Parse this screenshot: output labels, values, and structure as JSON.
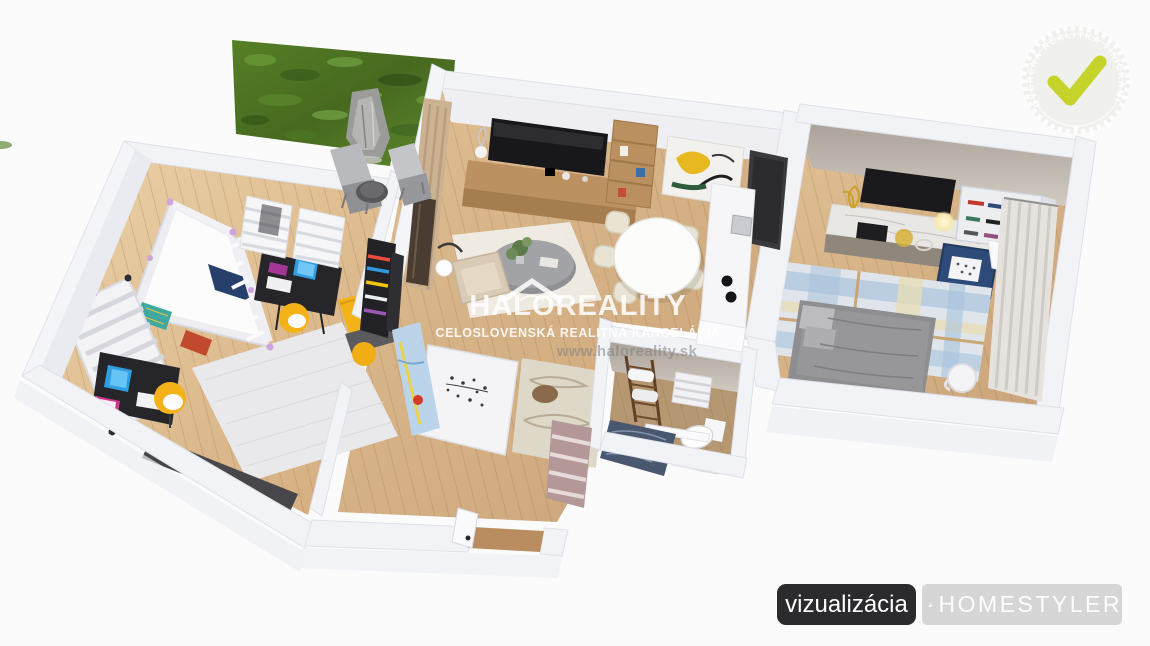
{
  "watermark": {
    "title": "HALOREALITY",
    "subtitle": "CELOSLOVENSKÁ REALITNÁ KANCELÁRIA",
    "website": "www.haloreality.sk",
    "logo": "roof-icon"
  },
  "badge": {
    "circular_text": "OVERENÁ REALITKA TISÍCKAMI KLIENTOV",
    "star": "★",
    "check_icon": "checkmark-icon",
    "check_color": "#c6d32a"
  },
  "footer": {
    "visualization_label": "vizualizácia",
    "brand_name": "HOMESTYLER",
    "brand_icon": "layers-icon"
  },
  "scene": {
    "type": "3d-floorplan-render",
    "rooms": [
      "children-bedroom",
      "living-room-with-kitchen",
      "hallway",
      "bathroom",
      "bedroom"
    ],
    "exterior": [
      "green-wall-panel",
      "lounge-chairs"
    ]
  },
  "colors": {
    "background": "#fbfbfc",
    "wall": "#f2f3f7",
    "floor_wood": "#d9b98c",
    "accent_yellow": "#f3b218",
    "accent_navy": "#2e4a78",
    "check_green": "#c6d32a",
    "button_dark": "#2b2b2d",
    "button_light": "#d6d6d6"
  }
}
